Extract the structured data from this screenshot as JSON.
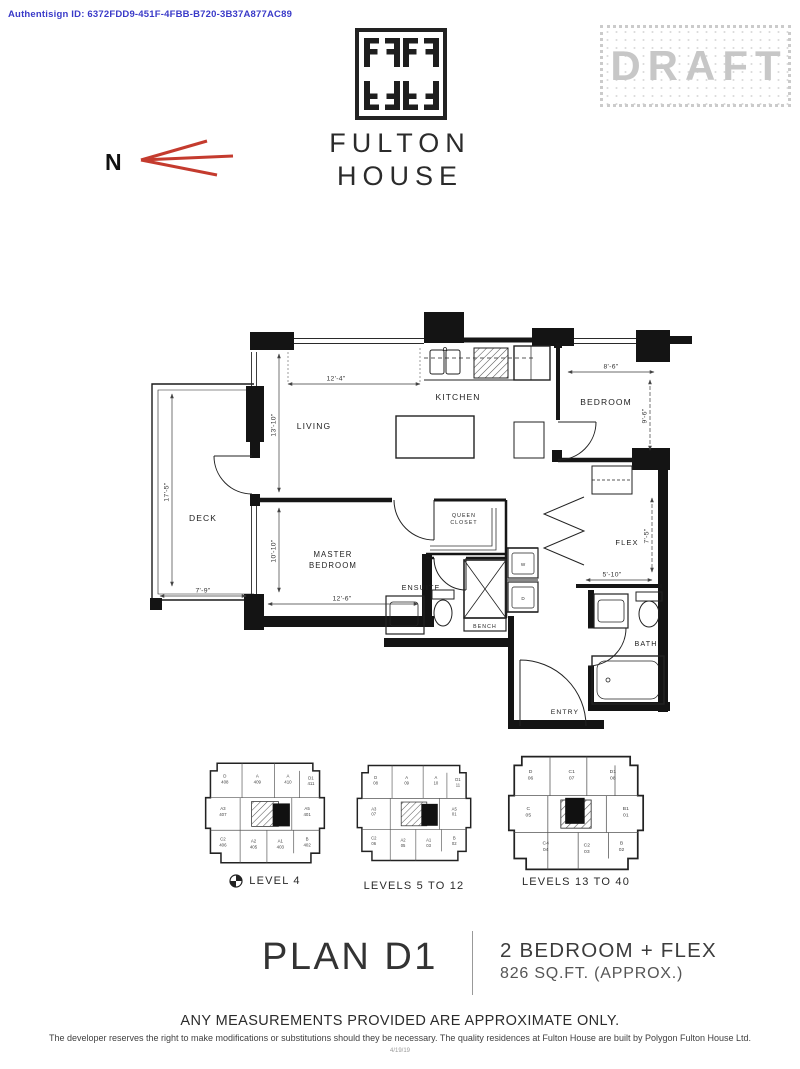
{
  "header": {
    "authentisign": "Authentisign ID: 6372FDD9-451F-4FBB-B720-3B37A877AC89",
    "draft": "DRAFT",
    "north_label": "N"
  },
  "brand": {
    "line1": "FULTON",
    "line2": "HOUSE"
  },
  "floorplan": {
    "rooms": {
      "living": "LIVING",
      "kitchen": "KITCHEN",
      "bedroom": "BEDROOM",
      "master_line1": "MASTER",
      "master_line2": "BEDROOM",
      "deck": "DECK",
      "closet_line1": "QUEEN",
      "closet_line2": "CLOSET",
      "ensuite": "ENSUITE",
      "bench": "BENCH",
      "flex": "FLEX",
      "bath": "BATH",
      "entry": "ENTRY",
      "washer": "W",
      "dryer": "D"
    },
    "dims": {
      "living_w": "12'-4\"",
      "living_h": "13'-10\"",
      "deck_h": "17'-5\"",
      "deck_w": "7'-9\"",
      "bedroom_w": "8'-6\"",
      "bedroom_h": "9'-6\"",
      "master_w": "12'-6\"",
      "master_h": "10'-10\"",
      "flex_w": "5'-10\"",
      "flex_h": "7'-5\""
    }
  },
  "keyplans": [
    {
      "label": "LEVEL 4",
      "units": [
        {
          "l": "D",
          "n": "408"
        },
        {
          "l": "A",
          "n": "409"
        },
        {
          "l": "A",
          "n": "410"
        },
        {
          "l": "D1",
          "n": "411"
        },
        {
          "l": "A3",
          "n": "407"
        },
        {
          "l": "A5",
          "n": "401"
        },
        {
          "l": "C2",
          "n": "406"
        },
        {
          "l": "A2",
          "n": "405"
        },
        {
          "l": "A1",
          "n": "403"
        },
        {
          "l": "B",
          "n": "402"
        }
      ]
    },
    {
      "label": "LEVELS 5 TO 12",
      "units": [
        {
          "l": "D",
          "n": "08"
        },
        {
          "l": "A",
          "n": "09"
        },
        {
          "l": "A",
          "n": "10"
        },
        {
          "l": "D1",
          "n": "11"
        },
        {
          "l": "A3",
          "n": "07"
        },
        {
          "l": "A5",
          "n": "01"
        },
        {
          "l": "C2",
          "n": "06"
        },
        {
          "l": "A2",
          "n": "05"
        },
        {
          "l": "A1",
          "n": "03"
        },
        {
          "l": "B",
          "n": "02"
        }
      ]
    },
    {
      "label": "LEVELS 13 TO 40",
      "units": [
        {
          "l": "D",
          "n": "06"
        },
        {
          "l": "C1",
          "n": "07"
        },
        {
          "l": "D1",
          "n": "08"
        },
        {
          "l": "C",
          "n": "05"
        },
        {
          "l": "B1",
          "n": "01"
        },
        {
          "l": "C4",
          "n": "04"
        },
        {
          "l": "C2",
          "n": "03"
        },
        {
          "l": "B",
          "n": "02"
        }
      ]
    }
  ],
  "plan_info": {
    "name": "PLAN D1",
    "type": "2 BEDROOM + FLEX",
    "area": "826 SQ.FT. (APPROX.)"
  },
  "footer": {
    "measurements": "ANY MEASUREMENTS PROVIDED ARE APPROXIMATE ONLY.",
    "disclaimer": "The developer reserves the right to make modifications or substitutions should they be necessary. The quality residences at Fulton House are built by Polygon Fulton House Ltd.",
    "doc_ref": "4/19/19"
  }
}
